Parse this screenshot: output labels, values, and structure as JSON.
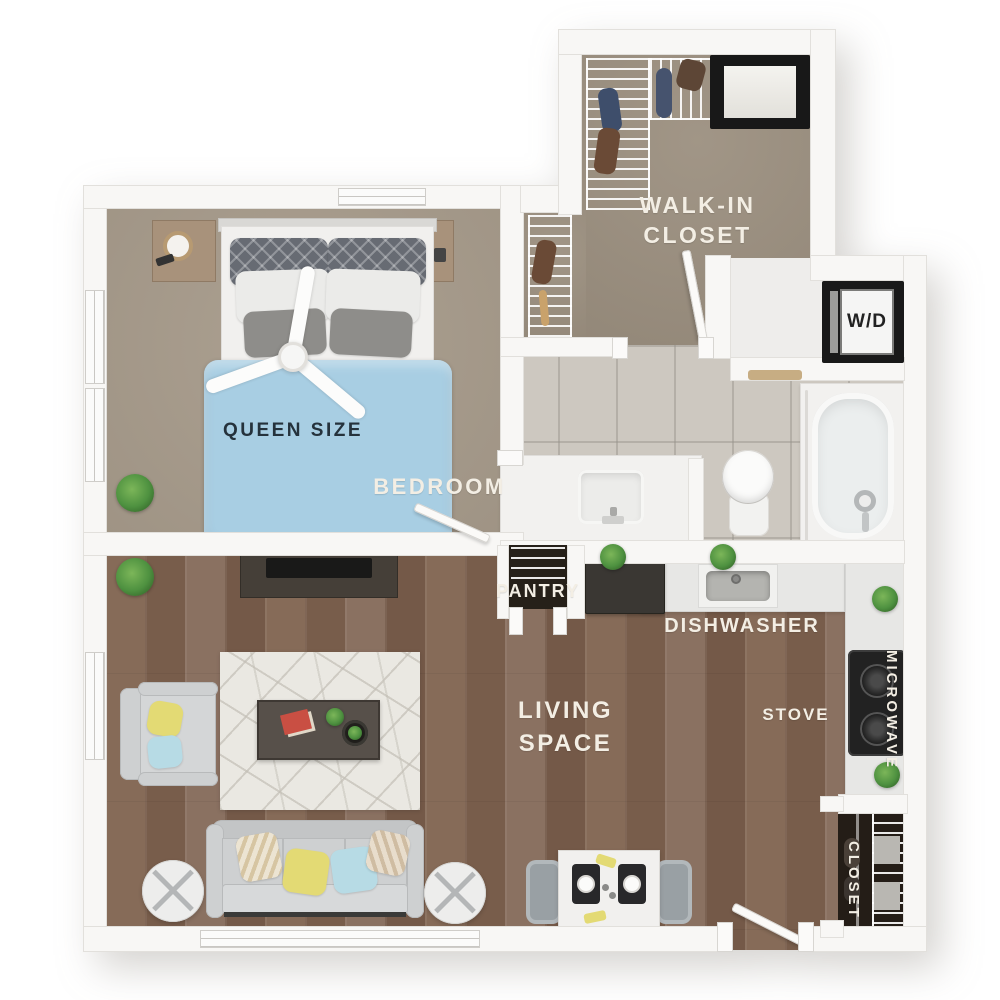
{
  "labels": {
    "walk_in_closet_line1": "WALK-IN",
    "walk_in_closet_line2": "CLOSET",
    "washer_dryer": "W/D",
    "bedroom": "BEDROOM",
    "queen_size": "QUEEN SIZE",
    "pantry": "PANTRY",
    "dishwasher": "DISHWASHER",
    "living_space_line1": "LIVING",
    "living_space_line2": "SPACE",
    "stove": "STOVE",
    "microwave": "MICROWAVE",
    "entry_closet": "CLOSET"
  },
  "colors": {
    "wall": "#f8f7f5",
    "bedroom_carpet": "#a79b8b",
    "closet_carpet": "#9c9080",
    "bathroom_tile": "#cdc8c0",
    "wood_floor": "#7f6451",
    "bed_duvet": "#a8cee3",
    "label_text": "#f3eee4",
    "dark_label_text": "#25323c",
    "counter": "#e7e7e5",
    "appliance_dark": "#3a3733",
    "accent_yellow": "#e3da74",
    "accent_blue": "#b7dbe5",
    "plant_green": "#4e9140",
    "pantry_dark": "#262019",
    "rug": "#eae8e2",
    "sofa_gray": "#ced0d1"
  }
}
